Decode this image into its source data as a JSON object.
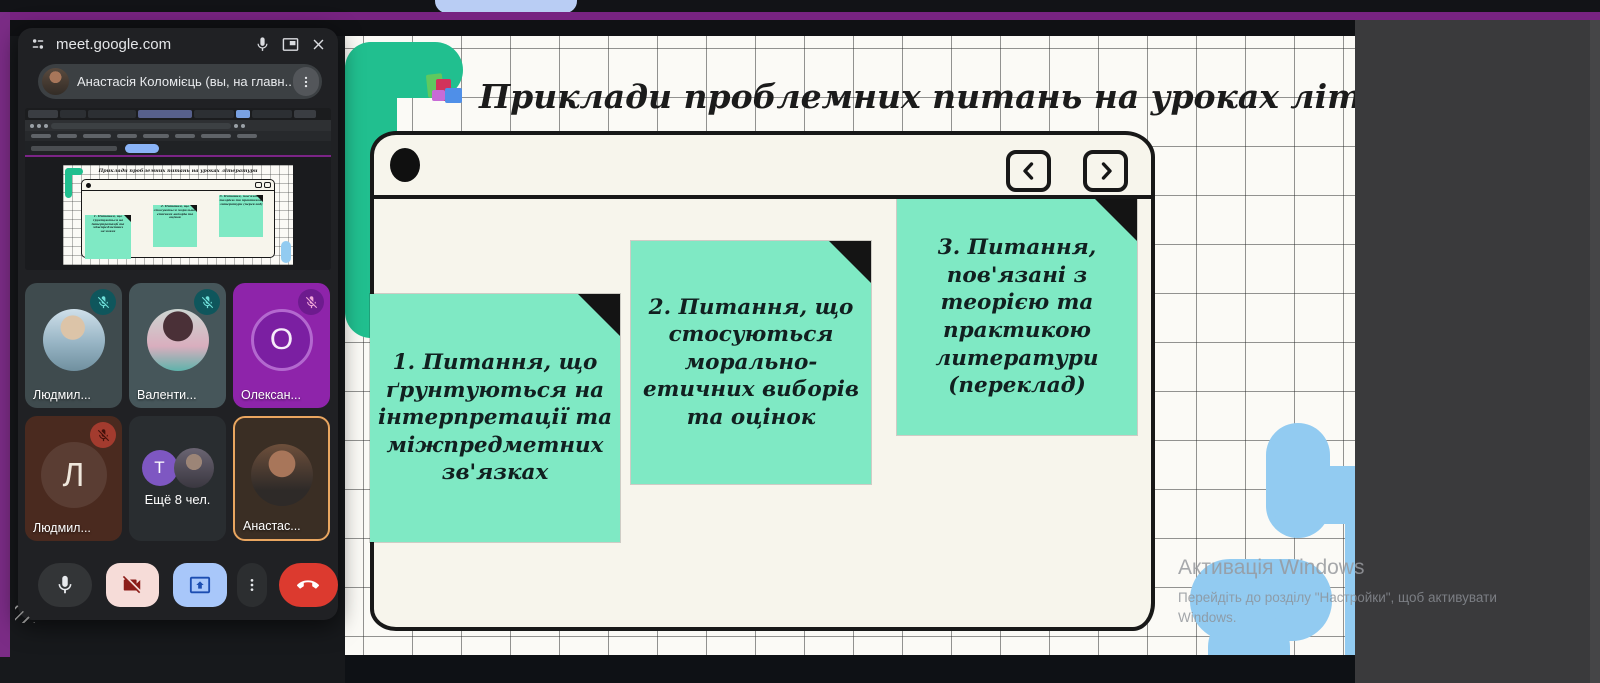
{
  "meet": {
    "window_title": "meet.google.com",
    "self_banner": "Анастасія Коломієць (вы, на главн...",
    "participants": [
      {
        "name": "Людмил...",
        "avatar_type": "photo",
        "muted": true
      },
      {
        "name": "Валенти...",
        "avatar_type": "photo",
        "muted": true
      },
      {
        "name": "Олексан...",
        "avatar_type": "letter",
        "letter": "О",
        "muted": true
      },
      {
        "name": "Людмил...",
        "avatar_type": "letter",
        "letter": "Л",
        "muted": true
      },
      {
        "name": "Ещё 8 чел.",
        "avatar_type": "group",
        "letter": "T",
        "muted": false
      },
      {
        "name": "Анастас...",
        "avatar_type": "photo",
        "active_speaker": true,
        "muted": false
      }
    ],
    "controls": {
      "mic": "mic",
      "camera": "videocam-off",
      "present": "present-to-all",
      "more": "more-options",
      "end_call": "call-end"
    }
  },
  "slide": {
    "title": "Приклади проблемних питань на уроках літератури",
    "icon": "books-icon",
    "nav": {
      "prev": "chevron-left",
      "next": "chevron-right"
    },
    "notes": [
      {
        "text": "1. Питання, що ґрунтуються на інтерпретації та міжпредметних зв'язках"
      },
      {
        "text": "2. Питання, що стосуються морально-етичних виборів та оцінок"
      },
      {
        "text": "3. Питання, пов'язані з теорією та практикою литератури (переклад)"
      }
    ]
  },
  "watermark": {
    "line1": "Активація Windows",
    "line2": "Перейдіть до розділу \"Настройки\", щоб активувати",
    "line3": "Windows."
  },
  "colors": {
    "note_green": "#7fe9c4",
    "squiggle_green": "#21bf8f",
    "squiggle_blue": "#92cbf1",
    "frame_purple": "#7b2c86",
    "card_bg": "#f7f5ec",
    "tile_purple": "#8e24aa",
    "active_speaker_border": "#e9a660",
    "end_call_red": "#dc3a2f",
    "present_blue": "#a8c7fa",
    "camera_pink": "#f6dcd8"
  }
}
